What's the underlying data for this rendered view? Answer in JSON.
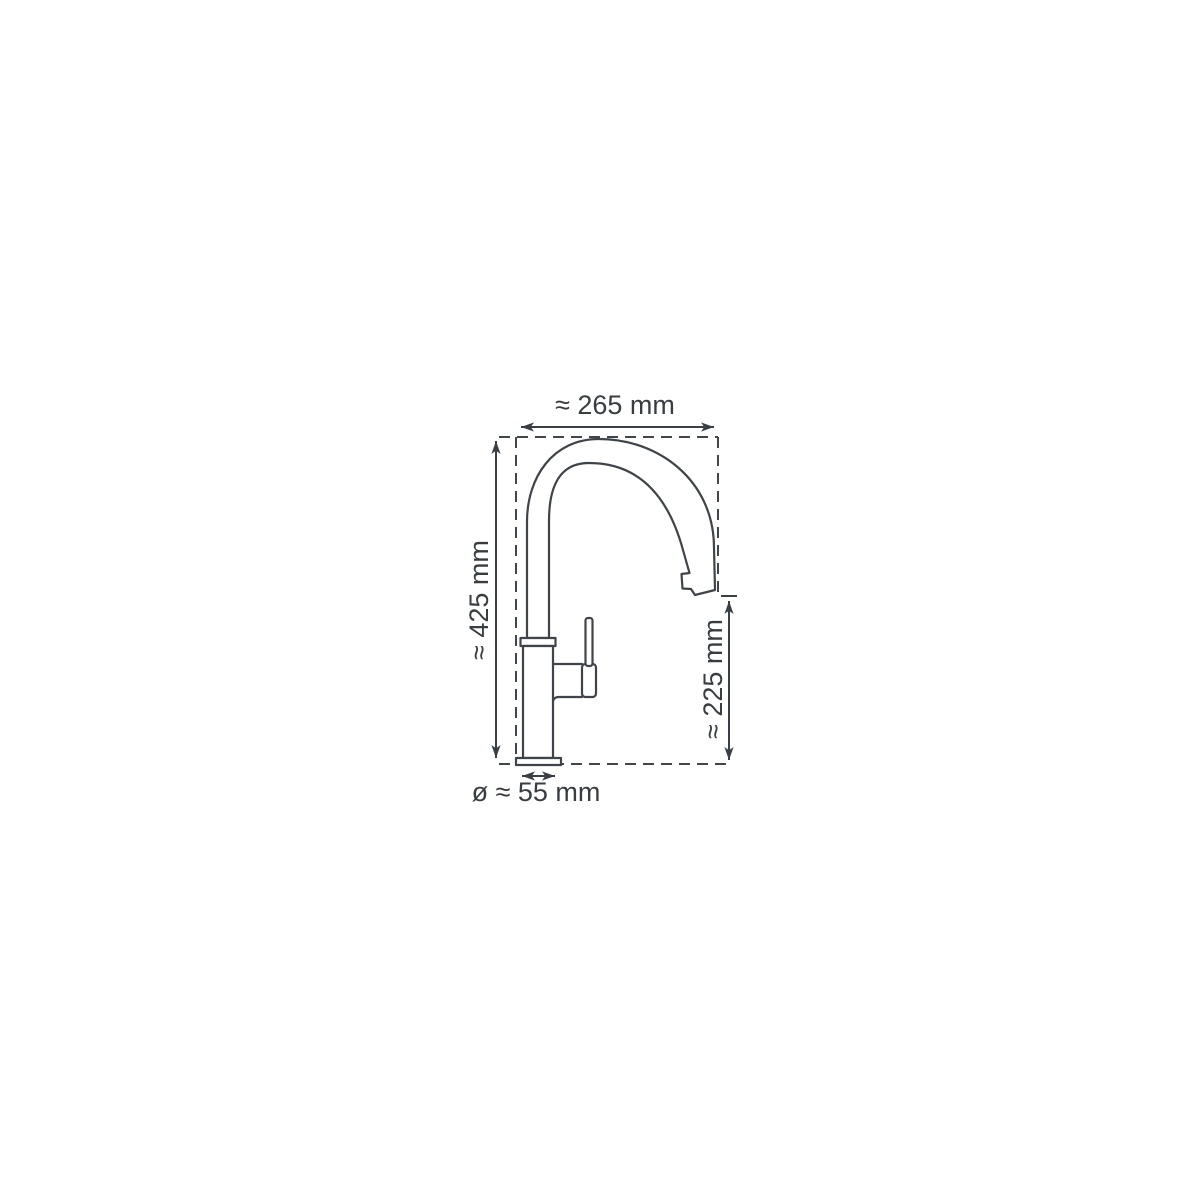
{
  "diagram": {
    "type": "technical-dimension-drawing",
    "subject": "single-lever kitchen faucet with high-arc gooseneck spout, side view",
    "colors": {
      "background": "#ffffff",
      "line": "#3f444a",
      "text": "#383d42"
    },
    "labels": {
      "spout_width": "≈ 265 mm",
      "total_height": "≈ 425 mm",
      "outlet_height": "≈ 225 mm",
      "base_diameter": "ø ≈ 55 mm"
    }
  }
}
